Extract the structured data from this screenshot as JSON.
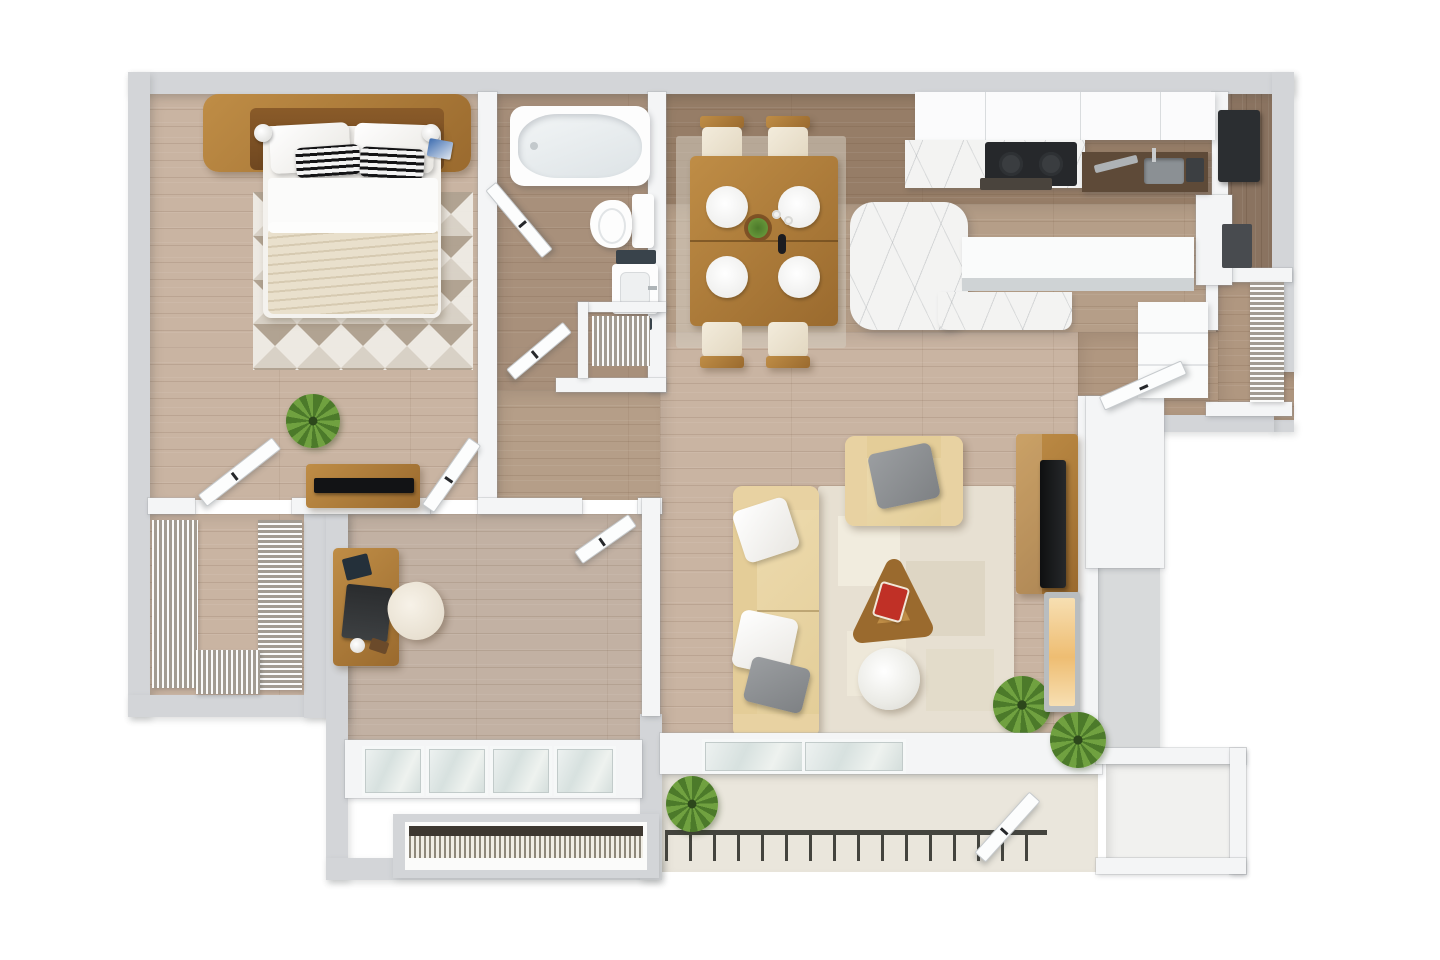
{
  "scene": {
    "type": "3d-floor-plan-top-down-render",
    "description": "One-bedroom apartment with den, open kitchen/living area and balcony",
    "rooms": [
      {
        "name": "bedroom",
        "furniture": [
          "platform-bed",
          "wood-headboard-with-nightstands",
          "table-lamp-left",
          "table-lamp-right",
          "white-pillows",
          "striped-accent-pillows",
          "cream-blanket",
          "triangle-pattern-rug",
          "dresser",
          "flat-tv",
          "potted-plant",
          "closet-door",
          "hall-door"
        ]
      },
      {
        "name": "walk-in-closet",
        "furniture": [
          "wire-shelving-left",
          "wire-shelving-right",
          "wire-shelving-bottom"
        ]
      },
      {
        "name": "bathroom",
        "furniture": [
          "jetted-bathtub",
          "toilet",
          "vanity-sink",
          "dark-towels",
          "linen-closet-wire-shelf",
          "bath-door-upper",
          "bath-door-lower"
        ]
      },
      {
        "name": "den-office",
        "furniture": [
          "writing-desk",
          "laptop",
          "notebook",
          "mug",
          "task-chair",
          "window-bay",
          "hvac-grille",
          "office-door"
        ]
      },
      {
        "name": "kitchen",
        "furniture": [
          "upper-cabinets",
          "marble-countertop",
          "cooktop",
          "oven-front",
          "prep-counter-with-sink",
          "tall-dark-appliance",
          "breakfast-bar-peninsula",
          "bar-counter"
        ]
      },
      {
        "name": "dining-area",
        "furniture": [
          "dining-table",
          "place-setting-1",
          "place-setting-2",
          "place-setting-3",
          "place-setting-4",
          "centerpiece-bowl",
          "wine-bottle",
          "dining-chair-1",
          "dining-chair-2",
          "dining-chair-3",
          "dining-chair-4",
          "dining-rug"
        ]
      },
      {
        "name": "living-room",
        "furniture": [
          "three-seat-sofa",
          "armchair",
          "triangle-coffee-table",
          "magazines",
          "pouf",
          "patchwork-rug",
          "tv-console",
          "flat-tv",
          "electric-fireplace",
          "potted-plant"
        ]
      },
      {
        "name": "entry-hall",
        "furniture": [
          "entry-door",
          "coat-closet-wire-shelf",
          "pantry-cabinets"
        ]
      },
      {
        "name": "utility-room",
        "furniture": [
          "water-heater",
          "utility-box"
        ]
      },
      {
        "name": "balcony",
        "furniture": [
          "railing",
          "sliding-glass-door",
          "potted-plant-left",
          "potted-plant-right",
          "storage-closet",
          "storage-door"
        ]
      }
    ],
    "counts": {
      "doors": 8,
      "plants": 4,
      "dining_seats": 4,
      "bathrooms": 1,
      "bedrooms": 2
    }
  },
  "palette": {
    "wall": "#d3d5d8",
    "wallFace": "#f4f5f6",
    "woodMain": "#c9b4a2",
    "woodMid": "#b59e88",
    "woodOffice": "#c2b1a3",
    "woodBath": "#a8907b",
    "woodKitchen": "#967d67",
    "woodCorridor": "#b09780",
    "woodUtility": "#8a7360",
    "woodFurn": "#bf8d46",
    "woodFurnDark": "#9a6a2e",
    "marble": "#f3f3f2",
    "counterDark": "#5e4a38",
    "cream": "#eee4cf",
    "blanket": "#e9e0cc",
    "sofa": "#ecd9ad",
    "pillowGray": "#8f9295",
    "dark": "#2b2e31",
    "glass": "#dfe7e6",
    "concrete": "#eae6dc",
    "plantGreen": "#55812f",
    "glowLight": "#f7dfb2",
    "glowDeep": "#eebd72",
    "rugBase": "#efece5",
    "rugTaupe": "#b0a291",
    "rugSand": "#d9d3c8",
    "railing": "#44443e",
    "magazineRed": "#c03026"
  }
}
